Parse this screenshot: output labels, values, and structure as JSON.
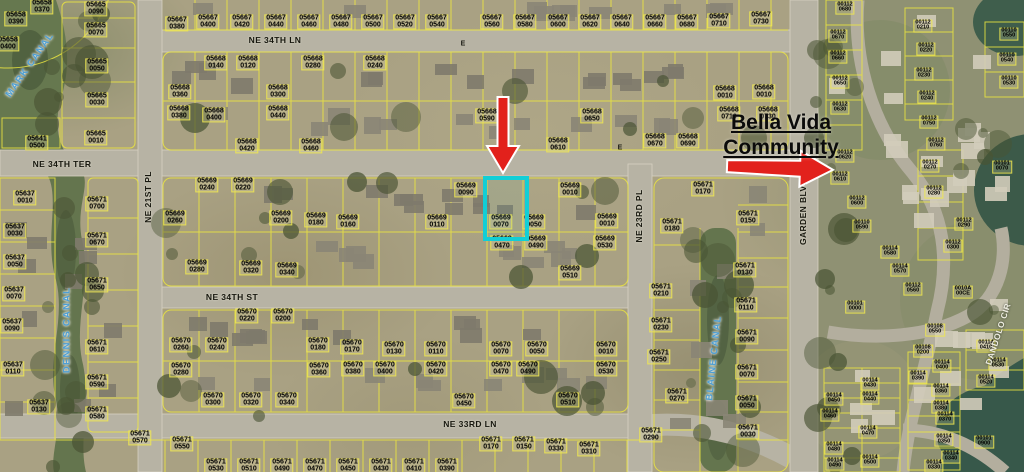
{
  "map": {
    "colors": {
      "arrow_red": "#e2211c",
      "highlight_cyan": "#12ced6",
      "parcel_line_yellow": "#ece63f",
      "canal_text_blue": "#4e9fd4"
    },
    "community_label": {
      "line1": "Bella Vida",
      "line2": "Community"
    },
    "highlighted_parcel": {
      "book": "05669",
      "lot": "0070",
      "x": 483,
      "y": 176,
      "w": 38,
      "h": 57
    },
    "annotations": {
      "arrows": [
        {
          "name": "down-arrow",
          "points_to": "05669 0070"
        },
        {
          "name": "right-arrow",
          "points_to": "Bella Vida Community entrance"
        }
      ]
    },
    "streets": [
      {
        "name": "NE 34TH LN",
        "x": 275,
        "y": 40,
        "rotate": 0
      },
      {
        "name": "NE 34TH TER",
        "x": 62,
        "y": 164,
        "rotate": 0
      },
      {
        "name": "NE 34TH ST",
        "x": 232,
        "y": 297,
        "rotate": 0
      },
      {
        "name": "NE 33RD LN",
        "x": 470,
        "y": 424,
        "rotate": 0
      },
      {
        "name": "NE 21ST PL",
        "x": 148,
        "y": 197,
        "rotate": -90
      },
      {
        "name": "NE 23RD PL",
        "x": 639,
        "y": 216,
        "rotate": -90
      },
      {
        "name": "GARDEN BLVD",
        "x": 803,
        "y": 212,
        "rotate": -90
      },
      {
        "name": "DANDOLO CIR",
        "x": 998,
        "y": 334,
        "rotate": -72,
        "light": true
      }
    ],
    "canals": [
      {
        "name": "MARK CANAL",
        "x": 30,
        "y": 65,
        "rotate": -55
      },
      {
        "name": "DENNIS CANAL",
        "x": 67,
        "y": 330,
        "rotate": -90
      },
      {
        "name": "BLAINE CANAL",
        "x": 714,
        "y": 358,
        "rotate": -84
      }
    ],
    "road_marks": [
      {
        "text": "E",
        "x": 463,
        "y": 44
      },
      {
        "text": "E",
        "x": 620,
        "y": 148
      }
    ],
    "parcels": [
      [
        "05658",
        "0370",
        42,
        7
      ],
      [
        "05658",
        "0390",
        16,
        19
      ],
      [
        "05658",
        "0400",
        8,
        44
      ],
      [
        "05665",
        "0090",
        96,
        9
      ],
      [
        "05665",
        "0070",
        96,
        30
      ],
      [
        "05665",
        "0050",
        97,
        66
      ],
      [
        "05665",
        "0030",
        97,
        100
      ],
      [
        "05665",
        "0010",
        96,
        138
      ],
      [
        "05641",
        "0500",
        37,
        143
      ],
      [
        "05667",
        "0380",
        177,
        24
      ],
      [
        "05667",
        "0400",
        208,
        22
      ],
      [
        "05667",
        "0420",
        242,
        22
      ],
      [
        "05667",
        "0440",
        276,
        22
      ],
      [
        "05667",
        "0460",
        309,
        22
      ],
      [
        "05667",
        "0480",
        341,
        22
      ],
      [
        "05667",
        "0500",
        373,
        22
      ],
      [
        "05667",
        "0520",
        405,
        22
      ],
      [
        "05667",
        "0540",
        437,
        22
      ],
      [
        "05667",
        "0560",
        492,
        22
      ],
      [
        "05667",
        "0580",
        525,
        22
      ],
      [
        "05667",
        "0600",
        558,
        22
      ],
      [
        "05667",
        "0620",
        590,
        22
      ],
      [
        "05667",
        "0640",
        622,
        22
      ],
      [
        "05667",
        "0660",
        655,
        22
      ],
      [
        "05667",
        "0680",
        687,
        22
      ],
      [
        "05667",
        "0710",
        719,
        21
      ],
      [
        "05667",
        "0730",
        761,
        19
      ],
      [
        "05668",
        "0140",
        216,
        63
      ],
      [
        "05668",
        "0120",
        248,
        63
      ],
      [
        "05668",
        "0280",
        313,
        63
      ],
      [
        "05668",
        "0240",
        375,
        63
      ],
      [
        "05668",
        "0360",
        180,
        92
      ],
      [
        "05668",
        "0300",
        278,
        92
      ],
      [
        "05668",
        "0380",
        179,
        113
      ],
      [
        "05668",
        "0400",
        214,
        115
      ],
      [
        "05668",
        "0440",
        278,
        113
      ],
      [
        "05668",
        "0420",
        247,
        146
      ],
      [
        "05668",
        "0460",
        311,
        146
      ],
      [
        "05668",
        "0590",
        487,
        116
      ],
      [
        "05668",
        "0610",
        558,
        145
      ],
      [
        "05668",
        "0650",
        592,
        116
      ],
      [
        "05668",
        "0670",
        655,
        141
      ],
      [
        "05668",
        "0690",
        688,
        141
      ],
      [
        "05668",
        "0010",
        725,
        93
      ],
      [
        "05668",
        "0010",
        764,
        92
      ],
      [
        "05668",
        "0710",
        729,
        114
      ],
      [
        "05668",
        "0730",
        768,
        114
      ],
      [
        "05669",
        "0240",
        207,
        185
      ],
      [
        "05669",
        "0220",
        243,
        185
      ],
      [
        "05669",
        "0260",
        175,
        218
      ],
      [
        "05669",
        "0200",
        281,
        218
      ],
      [
        "05669",
        "0180",
        316,
        220
      ],
      [
        "05669",
        "0160",
        348,
        222
      ],
      [
        "05669",
        "0280",
        197,
        267
      ],
      [
        "05669",
        "0320",
        251,
        268
      ],
      [
        "05669",
        "0340",
        287,
        270
      ],
      [
        "05669",
        "0110",
        437,
        222
      ],
      [
        "05669",
        "0090",
        466,
        190
      ],
      [
        "05669",
        "0070",
        501,
        222
      ],
      [
        "05669",
        "0050",
        534,
        222
      ],
      [
        "05669",
        "0010",
        570,
        190
      ],
      [
        "05669",
        "0010",
        607,
        221
      ],
      [
        "05669",
        "0470",
        502,
        243
      ],
      [
        "05669",
        "0490",
        536,
        243
      ],
      [
        "05669",
        "0510",
        570,
        273
      ],
      [
        "05669",
        "0530",
        605,
        243
      ],
      [
        "05670",
        "0220",
        247,
        316
      ],
      [
        "05670",
        "0200",
        283,
        316
      ],
      [
        "05670",
        "0260",
        181,
        345
      ],
      [
        "05670",
        "0240",
        217,
        345
      ],
      [
        "05670",
        "0280",
        181,
        370
      ],
      [
        "05670",
        "0300",
        213,
        400
      ],
      [
        "05670",
        "0320",
        251,
        400
      ],
      [
        "05670",
        "0340",
        287,
        400
      ],
      [
        "05670",
        "0180",
        318,
        345
      ],
      [
        "05670",
        "0360",
        319,
        370
      ],
      [
        "05670",
        "0170",
        352,
        347
      ],
      [
        "05670",
        "0130",
        394,
        349
      ],
      [
        "05670",
        "0110",
        436,
        349
      ],
      [
        "05670",
        "0070",
        501,
        349
      ],
      [
        "05670",
        "0050",
        537,
        349
      ],
      [
        "05670",
        "0010",
        606,
        349
      ],
      [
        "05670",
        "0380",
        353,
        369
      ],
      [
        "05670",
        "0400",
        385,
        369
      ],
      [
        "05670",
        "0420",
        436,
        369
      ],
      [
        "05670",
        "0470",
        501,
        369
      ],
      [
        "05670",
        "0490",
        528,
        369
      ],
      [
        "05670",
        "0530",
        606,
        369
      ],
      [
        "05670",
        "0450",
        464,
        401
      ],
      [
        "05670",
        "0510",
        568,
        400
      ],
      [
        "05671",
        "0700",
        97,
        204
      ],
      [
        "05671",
        "0670",
        97,
        240
      ],
      [
        "05671",
        "0650",
        97,
        285
      ],
      [
        "05671",
        "0610",
        97,
        347
      ],
      [
        "05671",
        "0590",
        97,
        382
      ],
      [
        "05671",
        "0580",
        97,
        414
      ],
      [
        "05671",
        "0570",
        140,
        438
      ],
      [
        "05671",
        "0550",
        182,
        444
      ],
      [
        "05671",
        "0170",
        703,
        189
      ],
      [
        "05671",
        "0180",
        672,
        226
      ],
      [
        "05671",
        "0150",
        748,
        218
      ],
      [
        "05671",
        "0130",
        745,
        270
      ],
      [
        "05671",
        "0110",
        746,
        305
      ],
      [
        "05671",
        "0090",
        747,
        337
      ],
      [
        "05671",
        "0070",
        747,
        372
      ],
      [
        "05671",
        "0050",
        747,
        403
      ],
      [
        "05671",
        "0030",
        748,
        432
      ],
      [
        "05671",
        "0210",
        661,
        291
      ],
      [
        "05671",
        "0230",
        661,
        325
      ],
      [
        "05671",
        "0250",
        659,
        357
      ],
      [
        "05671",
        "0270",
        677,
        396
      ],
      [
        "05671",
        "0290",
        651,
        435
      ],
      [
        "05671",
        "0310",
        589,
        449
      ],
      [
        "05671",
        "0330",
        556,
        446
      ],
      [
        "05671",
        "0170",
        491,
        444
      ],
      [
        "05671",
        "0150",
        524,
        444
      ],
      [
        "05671",
        "0530",
        216,
        466
      ],
      [
        "05671",
        "0510",
        249,
        466
      ],
      [
        "05671",
        "0490",
        282,
        466
      ],
      [
        "05671",
        "0470",
        315,
        466
      ],
      [
        "05671",
        "0450",
        348,
        466
      ],
      [
        "05671",
        "0430",
        381,
        466
      ],
      [
        "05671",
        "0410",
        414,
        466
      ],
      [
        "05671",
        "0390",
        447,
        466
      ],
      [
        "05637",
        "0010",
        25,
        198
      ],
      [
        "05637",
        "0030",
        15,
        231
      ],
      [
        "05637",
        "0050",
        15,
        262
      ],
      [
        "05637",
        "0070",
        14,
        294
      ],
      [
        "05637",
        "0090",
        12,
        326
      ],
      [
        "05637",
        "0110",
        13,
        369
      ],
      [
        "05637",
        "0130",
        39,
        407
      ],
      [
        "00112",
        "0680",
        845,
        8
      ],
      [
        "00112",
        "0670",
        838,
        36
      ],
      [
        "00112",
        "0660",
        838,
        57
      ],
      [
        "00112",
        "0650",
        840,
        82
      ],
      [
        "00112",
        "0630",
        840,
        108
      ],
      [
        "00112",
        "0620",
        845,
        156
      ],
      [
        "00112",
        "0610",
        840,
        178
      ],
      [
        "00112",
        "0600",
        857,
        202
      ],
      [
        "00112",
        "0560",
        913,
        289
      ],
      [
        "00112",
        "0210",
        923,
        26
      ],
      [
        "00112",
        "0220",
        926,
        49
      ],
      [
        "00112",
        "0230",
        924,
        74
      ],
      [
        "00112",
        "0240",
        927,
        97
      ],
      [
        "00112",
        "0750",
        929,
        122
      ],
      [
        "00112",
        "0760",
        936,
        144
      ],
      [
        "00112",
        "0270",
        930,
        166
      ],
      [
        "00112",
        "0280",
        934,
        192
      ],
      [
        "00112",
        "0290",
        964,
        224
      ],
      [
        "00112",
        "0300",
        953,
        246
      ],
      [
        "00110",
        "0590",
        862,
        226
      ],
      [
        "00110",
        "0550",
        1009,
        34
      ],
      [
        "00110",
        "0540",
        1007,
        59
      ],
      [
        "00110",
        "0530",
        1009,
        82
      ],
      [
        "00114",
        "0580",
        890,
        252
      ],
      [
        "00114",
        "0570",
        900,
        270
      ],
      [
        "00114",
        "0400",
        942,
        366
      ],
      [
        "00114",
        "0390",
        918,
        377
      ],
      [
        "00114",
        "0410",
        986,
        346
      ],
      [
        "00114",
        "0530",
        998,
        364
      ],
      [
        "00114",
        "0520",
        986,
        381
      ],
      [
        "00114",
        "0360",
        941,
        390
      ],
      [
        "00114",
        "0380",
        941,
        407
      ],
      [
        "00114",
        "0370",
        945,
        418
      ],
      [
        "00114",
        "0350",
        944,
        440
      ],
      [
        "00114",
        "0340",
        951,
        457
      ],
      [
        "00114",
        "0330",
        934,
        466
      ],
      [
        "00114",
        "0430",
        870,
        384
      ],
      [
        "00114",
        "0440",
        870,
        398
      ],
      [
        "00114",
        "0450",
        834,
        399
      ],
      [
        "00114",
        "0460",
        830,
        415
      ],
      [
        "00114",
        "0470",
        868,
        432
      ],
      [
        "00114",
        "0480",
        834,
        448
      ],
      [
        "00114",
        "0490",
        835,
        464
      ],
      [
        "00114",
        "0500",
        870,
        461
      ],
      [
        "00108",
        "0550",
        935,
        330
      ],
      [
        "00108",
        "0200",
        923,
        351
      ],
      [
        "0010A",
        "00CE",
        963,
        292
      ],
      [
        "00101",
        "0070",
        1002,
        167
      ],
      [
        "00101",
        "0900",
        984,
        442
      ],
      [
        "00101",
        "0000",
        855,
        307
      ]
    ]
  }
}
